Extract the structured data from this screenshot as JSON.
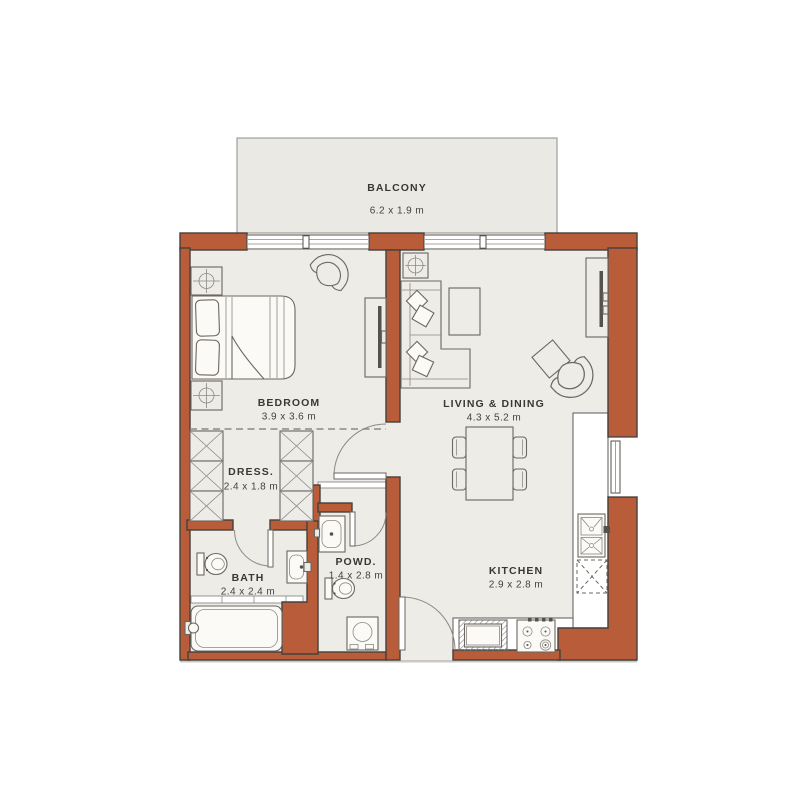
{
  "floorplan": {
    "type": "apartment-floor-plan",
    "rooms": {
      "balcony": {
        "label": "BALCONY",
        "dims": "6.2 x 1.9 m"
      },
      "bedroom": {
        "label": "BEDROOM",
        "dims": "3.9 x 3.6 m"
      },
      "living_dining": {
        "label": "LIVING & DINING",
        "dims": "4.3 x 5.2 m"
      },
      "dressing": {
        "label": "DRESS.",
        "dims": "2.4 x 1.8 m"
      },
      "bath": {
        "label": "BATH",
        "dims": "2.4 x 2.4 m"
      },
      "powder": {
        "label": "POWD.",
        "dims": "1.4 x 2.8 m"
      },
      "kitchen": {
        "label": "KITCHEN",
        "dims": "2.9 x 2.8 m"
      }
    },
    "colors": {
      "wall": "#b85c3a",
      "floor": "#edece7",
      "balcony_floor": "#eae9e4",
      "line": "#45413c"
    }
  }
}
